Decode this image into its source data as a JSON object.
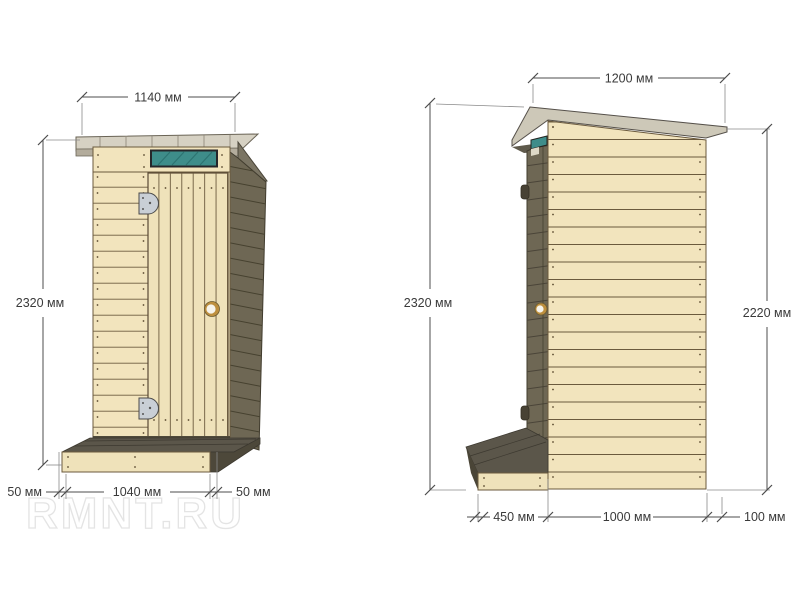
{
  "watermark": {
    "text": "RMNT.RU"
  },
  "front_view": {
    "dim_roof_width": "1140 мм",
    "dim_height": "2320 мм",
    "dim_bottom_left": "50 мм",
    "dim_platform_width": "1040 мм",
    "dim_bottom_right": "50 мм"
  },
  "side_view": {
    "dim_roof_width": "1200 мм",
    "dim_height_front": "2320 мм",
    "dim_height_back": "2220 мм",
    "dim_step_depth": "450 мм",
    "dim_cabin_depth": "1000 мм",
    "dim_roof_overhang": "100 мм"
  },
  "colors": {
    "plank_light": "#F2E4BD",
    "plank_dark": "#6E6754",
    "roof_gray": "#D6D1C3",
    "window_teal": "#3E8D8A",
    "knob_gold": "#BD8F3E",
    "dimension": "#4C4C4C",
    "background": "#FFFFFF"
  }
}
